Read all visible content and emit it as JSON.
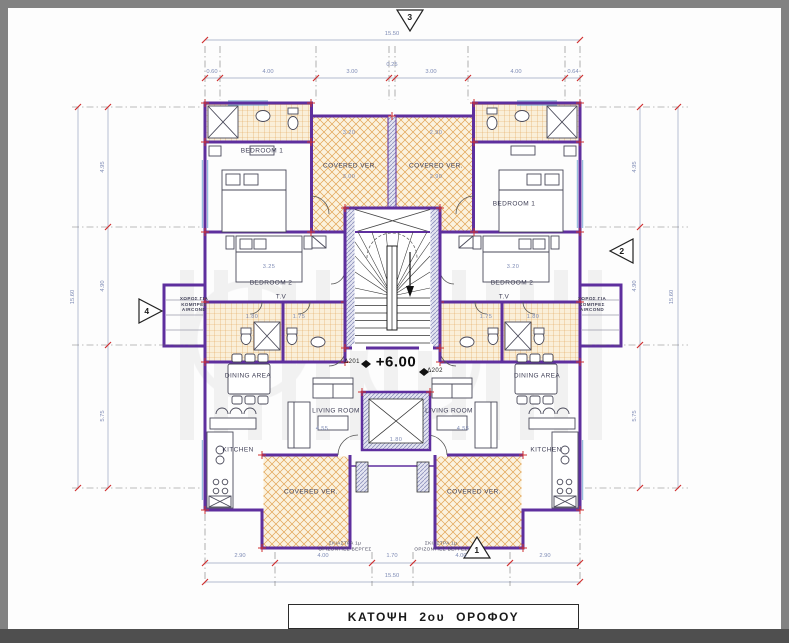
{
  "title_block": {
    "label": "ΚΑΤΟΨΗ 2ου ΟΡΟΦΟΥ"
  },
  "level_marker": {
    "left_tag": "Δ201",
    "value": "+6.00",
    "right_tag": "Δ202"
  },
  "section_markers": {
    "top": "3",
    "right": "2",
    "bottom": "1",
    "left": "4"
  },
  "rooms": {
    "bedroom1_left": "BEDROOM 1",
    "bedroom1_right": "BEDROOM 1",
    "bedroom2_left": "BEDROOM 2",
    "bedroom2_right": "BEDROOM 2",
    "ver_top_left": "COVERED VER.",
    "ver_top_right": "COVERED VER.",
    "ver_bottom_left": "COVERED VER.",
    "ver_bottom_right": "COVERED VER.",
    "dining_left": "DINING AREA",
    "dining_right": "DINING AREA",
    "living_left": "LIVING ROOM",
    "living_right": "LIVING ROOM",
    "kitchen_left": "KITCHEN",
    "kitchen_right": "KITCHEN",
    "tv_left": "T.V",
    "tv_right": "T.V",
    "aircond_left": "ΧΩΡΟΣ ΓΙΑ ΚΟΜΠΡΕΣ AIRCOND",
    "aircond_right": "ΧΩΡΟΣ ΓΙΑ ΚΟΜΠΡΕΣ AIRCOND"
  },
  "notes": {
    "shade_left": "ΣΚΙΑΣΤΡΑ 1μ ΟΡΙΖΟΝΤΙΕΣ ΒΕΡΓΕΣ",
    "shade_right": "ΣΚΙΑΣΤΡΑ 1μ ΟΡΙΖΟΝΤΙΕΣ ΒΕΡΓΕΣ"
  },
  "dimensions": {
    "top": {
      "overall": "15.50",
      "segments": [
        "0.60",
        "4.00",
        "3.00",
        "0.25",
        "3.00",
        "4.00",
        "0.64"
      ]
    },
    "bottom": {
      "overall": "15.50",
      "segments": [
        "2.90",
        "4.00",
        "1.70",
        "4.00",
        "2.90"
      ]
    },
    "left": {
      "overall": "15.60",
      "segments": [
        "4.95",
        "4.90",
        "5.75"
      ]
    },
    "right": {
      "overall": "15.60",
      "segments": [
        "4.95",
        "4.90",
        "5.75"
      ]
    }
  },
  "interior_dims": [
    "3.20",
    "3.00",
    "2.90",
    "2.90",
    "3.25",
    "3.20",
    "1.80",
    "1.75",
    "1.75",
    "1.80",
    "4.55",
    "4.55",
    "1.80"
  ],
  "palette": {
    "walls": "#5e2f9e",
    "tile_hatch": "#e2a455",
    "ticks": "#d03030",
    "dim_text": "#7e8bb5"
  }
}
